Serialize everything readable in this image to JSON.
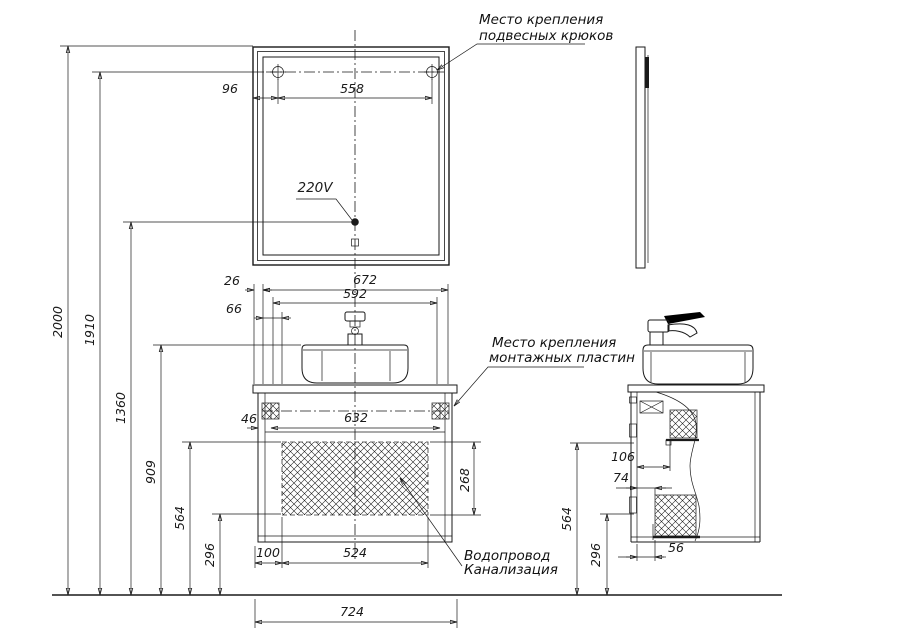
{
  "drawing": {
    "type": "bathroom vanity and mirror installation drawing",
    "paper_color": "#ffffff",
    "ink_color": "#1a1a1a",
    "labels": {
      "hooks_line1": "Место крепления",
      "hooks_line2": "подвесных крюков",
      "plates_line1": "Место крепления",
      "plates_line2": "монтажных пластин",
      "plumbing_line1": "Водопровод",
      "plumbing_line2": "Канализация",
      "power": "220V"
    },
    "dimensions": {
      "d2000": "2000",
      "d1910": "1910",
      "d1360": "1360",
      "d909": "909",
      "d564": "564",
      "d296": "296",
      "d96": "96",
      "d558": "558",
      "d26": "26",
      "d672": "672",
      "d592": "592",
      "d66": "66",
      "d46": "46",
      "d632": "632",
      "d268": "268",
      "d100": "100",
      "d524": "524",
      "d724": "724",
      "d106": "106",
      "d74": "74",
      "d56": "56"
    }
  }
}
